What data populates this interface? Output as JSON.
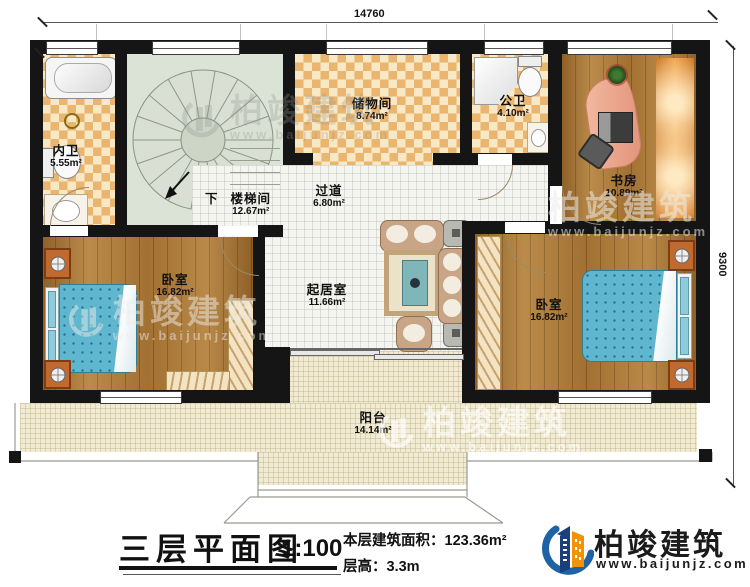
{
  "dimensions": {
    "width_label": "14760",
    "height_label": "9300"
  },
  "rooms": {
    "neiwei": {
      "name": "内卫",
      "area": "5.55m²"
    },
    "loutijian": {
      "name": "楼梯间",
      "area": "12.67m²",
      "down": "下"
    },
    "chuwujian": {
      "name": "储物间",
      "area": "8.74m²"
    },
    "gongwei": {
      "name": "公卫",
      "area": "4.10m²"
    },
    "shufang": {
      "name": "书房",
      "area": "10.89m²"
    },
    "guodao": {
      "name": "过道",
      "area": "6.80m²"
    },
    "woshi_left": {
      "name": "卧室",
      "area": "16.82m²"
    },
    "qijushi": {
      "name": "起居室",
      "area": "11.66m²"
    },
    "woshi_right": {
      "name": "卧室",
      "area": "16.82m²"
    },
    "yangtai": {
      "name": "阳台",
      "area": "14.14m²"
    }
  },
  "title_block": {
    "title": "三层平面图",
    "scale": "1:100",
    "area_line": "本层建筑面积：123.36m²",
    "floor_height_line": "层高：3.3m"
  },
  "brand": {
    "name": "柏竣建筑",
    "site": "www.baijunjz.com"
  },
  "watermark": {
    "name": "柏竣建筑",
    "site": "www.baijunjz.com"
  },
  "colors": {
    "wall": "#151515",
    "tile_dark": "#e9b56f",
    "tile_light": "#f8e8c6",
    "wood": "#ad7a38",
    "stair_floor": "#dbe2d6",
    "corridor_tile": "#f4f4f1",
    "balcony": "#f1ebd3",
    "bed_blue": "#5fb6cf",
    "brand_blue": "#1e63a4",
    "brand_navy": "#1b3f7a",
    "brand_orange": "#f39208"
  }
}
